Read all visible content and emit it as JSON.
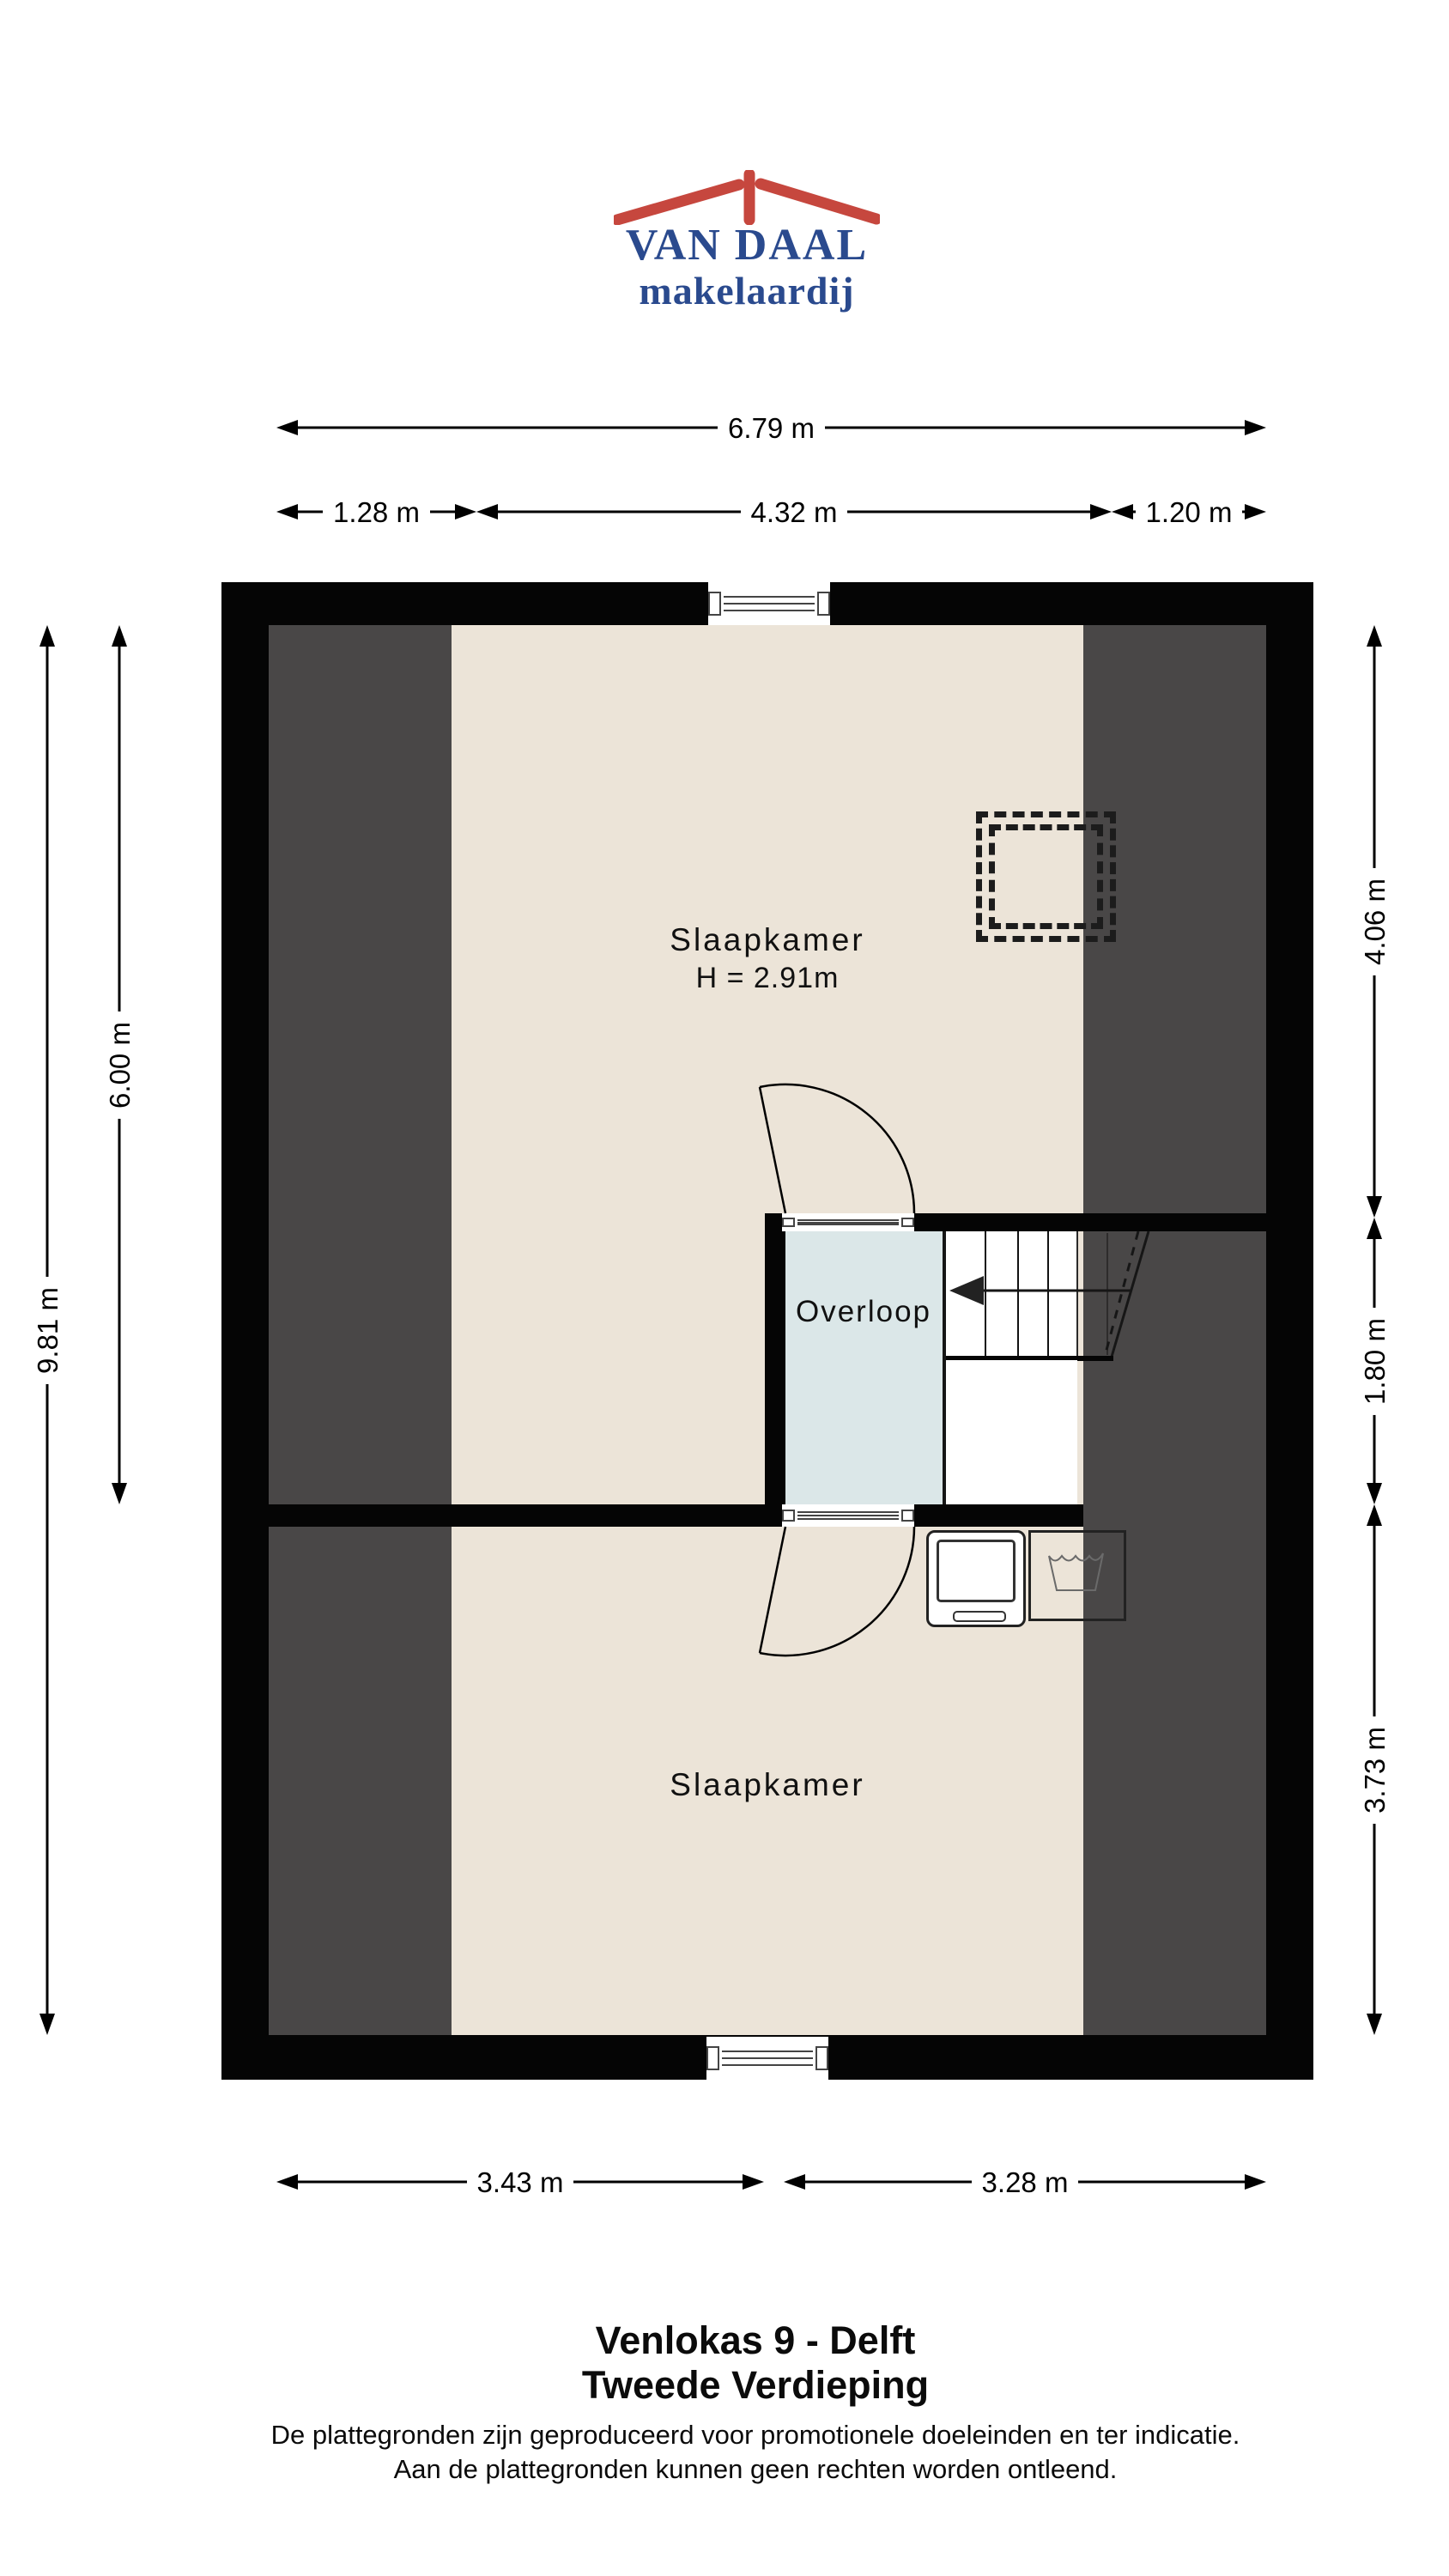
{
  "logo": {
    "name": "VAN DAAL",
    "tagline": "makelaardij",
    "roof_icon": "red-roof-with-chimney",
    "text_color": "#2a4a8e",
    "roof_color": "#c6473e"
  },
  "dimensions": {
    "top_total": "6.79 m",
    "top_left": "1.28 m",
    "top_center": "4.32 m",
    "top_right": "1.20 m",
    "left_total": "9.81 m",
    "left_upper": "6.00 m",
    "right_upper": "4.06 m",
    "right_middle": "1.80 m",
    "right_lower": "3.73 m",
    "bottom_left": "3.43 m",
    "bottom_right": "3.28 m"
  },
  "rooms": {
    "bedroom_top": {
      "label": "Slaapkamer",
      "ceiling_height": "H = 2.91m"
    },
    "landing": {
      "label": "Overloop"
    },
    "bedroom_bottom": {
      "label": "Slaapkamer"
    }
  },
  "footer": {
    "address": "Venlokas 9 - Delft",
    "floor": "Tweede Verdieping",
    "disclaimer_line1": "De plattegronden zijn geproduceerd voor promotionele doeleinden en ter indicatie.",
    "disclaimer_line2": "Aan de plattegronden kunnen geen rechten worden ontleend."
  },
  "colors": {
    "wall": "#050505",
    "floor": "#ece4d8",
    "sloped_ceiling_zone": "#494747",
    "landing_floor": "#dbe7e8",
    "logo_red": "#c6473e",
    "logo_blue": "#2a4a8e"
  }
}
